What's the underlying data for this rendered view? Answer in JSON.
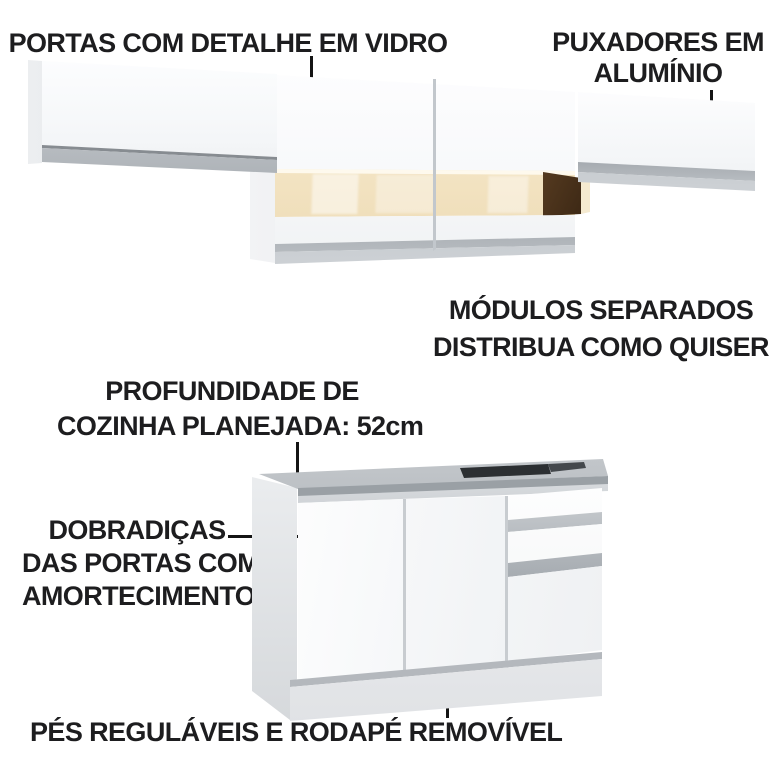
{
  "background_color": "#ffffff",
  "colors": {
    "text": "#1d1d1f",
    "line": "#141414",
    "cabinet-white": "#fcfdfe",
    "aluminum": "#9ba1a7",
    "glass": "#f2e2c0",
    "glass-light": "#faf0da",
    "wood": "#6b4b2a",
    "wood-dark": "#2e1d0e",
    "countertop": "#a8adb2",
    "sink": "#2c2f32",
    "plinth": "#f1f2f4",
    "shadow": "#b4b8bd"
  },
  "annotations": {
    "glass_doors": {
      "lines": [
        "PORTAS COM DETALHE EM VIDRO"
      ]
    },
    "aluminum_handles": {
      "lines": [
        "PUXADORES EM",
        "ALUMÍNIO"
      ]
    },
    "separate_modules": {
      "lines": [
        "MÓDULOS SEPARADOS",
        "DISTRIBUA COMO QUISER"
      ]
    },
    "depth": {
      "lines": [
        "PROFUNDIDADE DE",
        "COZINHA PLANEJADA: 52cm"
      ]
    },
    "hinges": {
      "lines": [
        "DOBRADIÇAS",
        "DAS PORTAS COM",
        "AMORTECIMENTO"
      ]
    },
    "feet": {
      "lines": [
        "PÉS REGULÁVEIS E RODAPÉ REMOVÍVEL"
      ]
    }
  }
}
